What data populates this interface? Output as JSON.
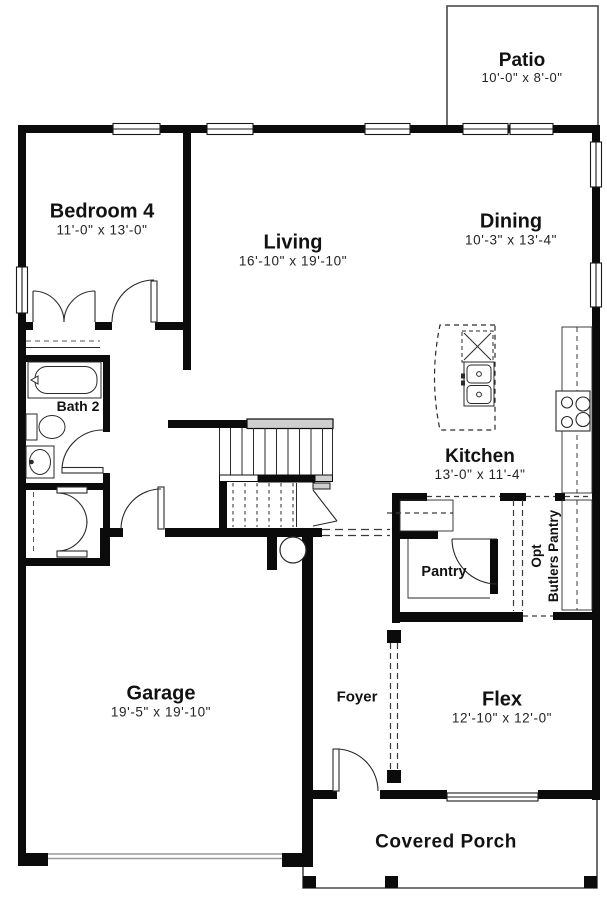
{
  "title": "Floor plan",
  "rooms": {
    "patio": {
      "name": "Patio",
      "dims": "10'-0\" x 8'-0\""
    },
    "bedroom4": {
      "name": "Bedroom 4",
      "dims": "11'-0\" x 13'-0\""
    },
    "living": {
      "name": "Living",
      "dims": "16'-10\" x 19'-10\""
    },
    "dining": {
      "name": "Dining",
      "dims": "10'-3\" x 13'-4\""
    },
    "bath2": {
      "name": "Bath 2"
    },
    "kitchen": {
      "name": "Kitchen",
      "dims": "13'-0\" x 11'-4\""
    },
    "pantry": {
      "name": "Pantry"
    },
    "butlers_pantry": {
      "line1": "Opt",
      "line2": "Butlers Pantry"
    },
    "garage": {
      "name": "Garage",
      "dims": "19'-5\" x 19'-10\""
    },
    "foyer": {
      "name": "Foyer"
    },
    "flex": {
      "name": "Flex",
      "dims": "12'-10\" x 12'-0\""
    },
    "covered_porch": {
      "name": "Covered Porch"
    }
  },
  "colors": {
    "walls": "#0b0b0b",
    "thin_lines": "#2a2a2a",
    "window_fill": "#ffffff",
    "railing_gray": "#cfcfcf",
    "background": "#ffffff"
  }
}
